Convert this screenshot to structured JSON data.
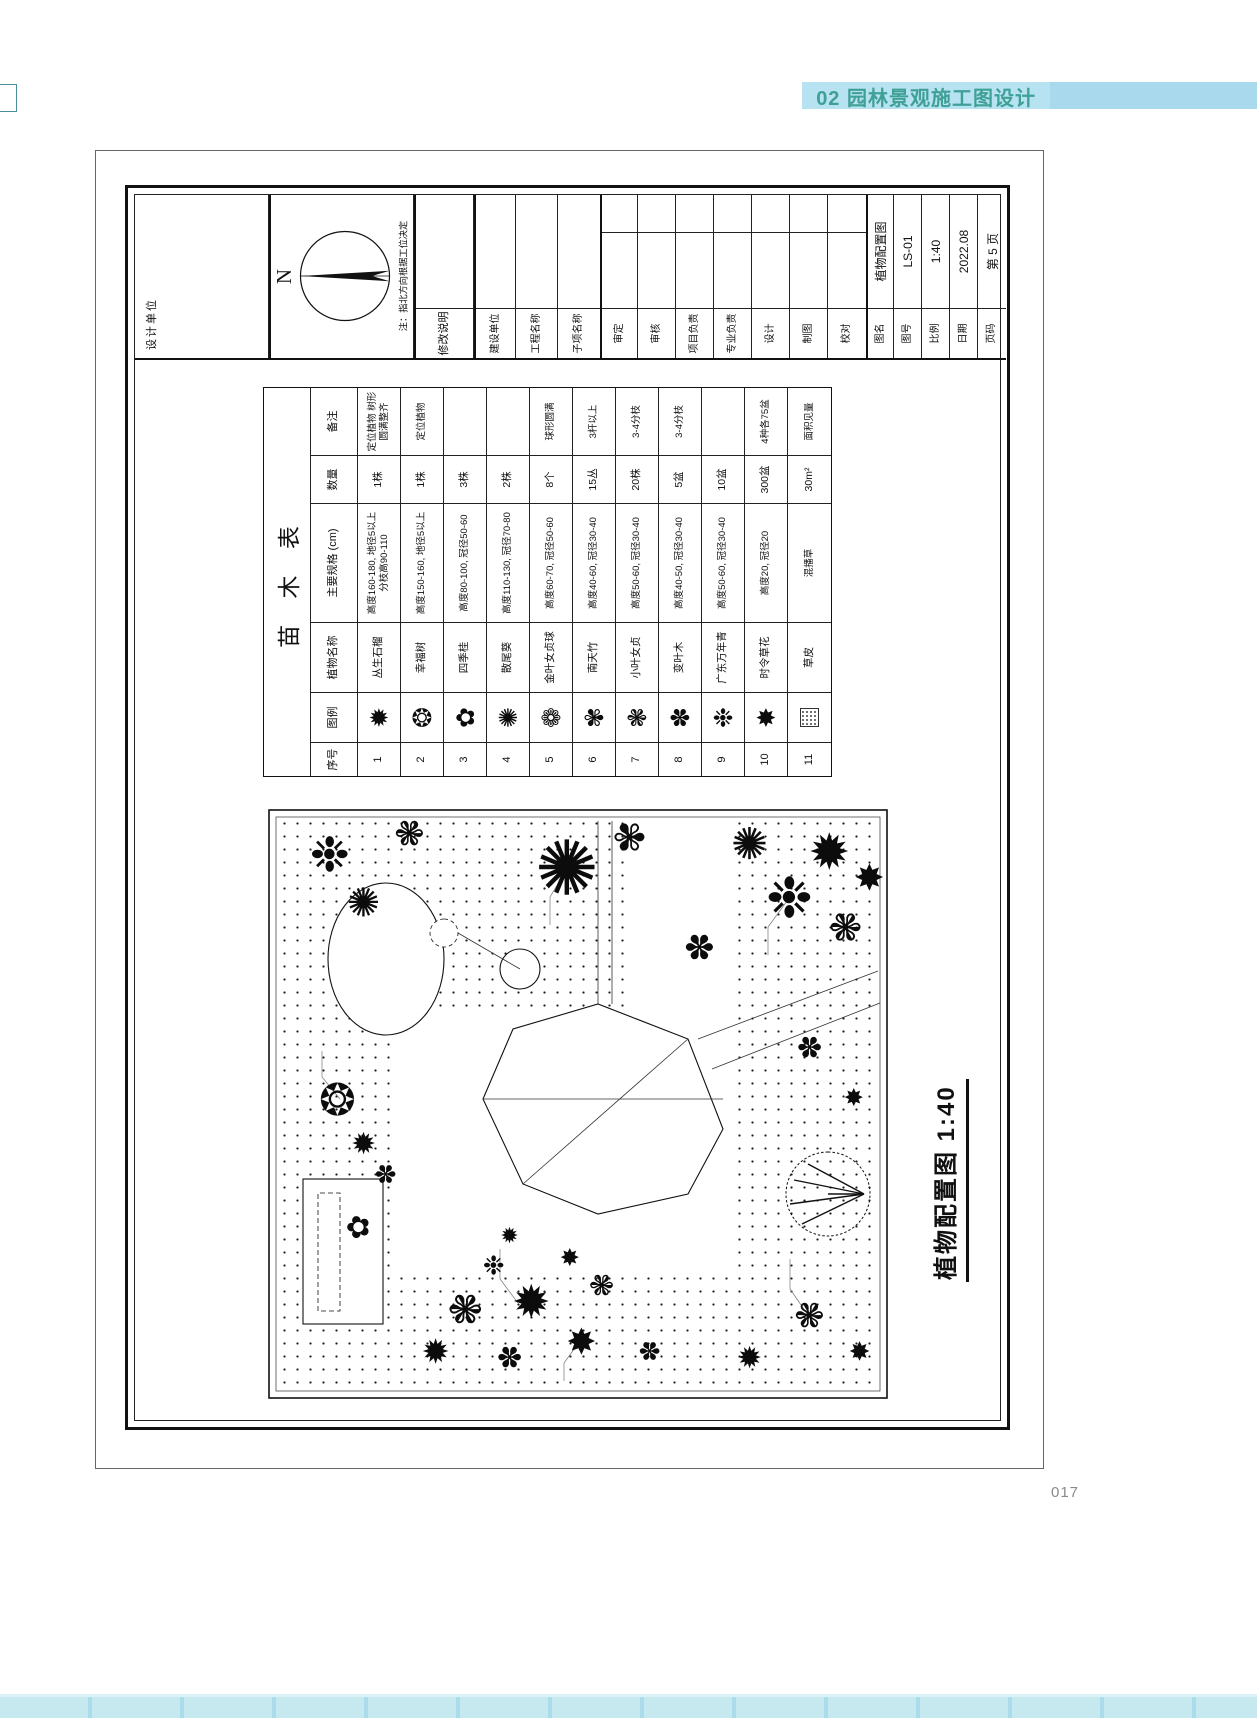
{
  "header": {
    "chapter": "02 园林景观施工图设计"
  },
  "page_number": "017",
  "title_block": {
    "design_unit_label": "设计单位",
    "north_letter": "N",
    "north_note": "注：指北方向根据工位决定",
    "revision_label": "修改说明",
    "project_fields": [
      {
        "label": "建设单位",
        "value": ""
      },
      {
        "label": "工程名称",
        "value": ""
      },
      {
        "label": "子项名称",
        "value": ""
      }
    ],
    "sign_fields": [
      {
        "label": "审定",
        "value": ""
      },
      {
        "label": "审核",
        "value": ""
      },
      {
        "label": "项目负责",
        "value": ""
      },
      {
        "label": "专业负责",
        "value": ""
      },
      {
        "label": "设计",
        "value": ""
      },
      {
        "label": "制图",
        "value": ""
      },
      {
        "label": "校对",
        "value": ""
      }
    ],
    "info_fields": [
      {
        "label": "图名",
        "value": "植物配置图"
      },
      {
        "label": "图号",
        "value": "LS-01"
      },
      {
        "label": "比例",
        "value": "1:40"
      },
      {
        "label": "日期",
        "value": "2022.08"
      },
      {
        "label": "页码",
        "value": "第 5 页"
      }
    ]
  },
  "plant_table": {
    "title": "苗 木 表",
    "headers": [
      "序号",
      "图例",
      "植物名称",
      "主要规格 (cm)",
      "数量",
      "备注"
    ],
    "rows": [
      {
        "no": "1",
        "symbol": "✹",
        "icon": "clump-pomegranate-icon",
        "name": "丛生石榴",
        "spec": "高度160-180, 地径5以上 分枝高90-110",
        "qty": "1株",
        "note": "定位植物 树形圆满整齐"
      },
      {
        "no": "2",
        "symbol": "❂",
        "icon": "happiness-tree-icon",
        "name": "幸福树",
        "spec": "高度150-160, 地径5以上",
        "qty": "1株",
        "note": "定位植物"
      },
      {
        "no": "3",
        "symbol": "✿",
        "icon": "osmanthus-icon",
        "name": "四季桂",
        "spec": "高度80-100, 冠径50-60",
        "qty": "3株",
        "note": ""
      },
      {
        "no": "4",
        "symbol": "✺",
        "icon": "areca-palm-icon",
        "name": "散尾葵",
        "spec": "高度110-130, 冠径70-80",
        "qty": "2株",
        "note": ""
      },
      {
        "no": "5",
        "symbol": "❁",
        "icon": "golden-privet-ball-icon",
        "name": "金叶女贞球",
        "spec": "高度60-70, 冠径50-60",
        "qty": "8个",
        "note": "球形圆满"
      },
      {
        "no": "6",
        "symbol": "✾",
        "icon": "nandina-icon",
        "name": "南天竹",
        "spec": "高度40-60, 冠径30-40",
        "qty": "15丛",
        "note": "3杆以上"
      },
      {
        "no": "7",
        "symbol": "❃",
        "icon": "small-privet-icon",
        "name": "小叶女贞",
        "spec": "高度50-60, 冠径30-40",
        "qty": "20株",
        "note": "3-4分枝"
      },
      {
        "no": "8",
        "symbol": "✽",
        "icon": "croton-icon",
        "name": "变叶木",
        "spec": "高度40-50, 冠径30-40",
        "qty": "5盆",
        "note": "3-4分枝"
      },
      {
        "no": "9",
        "symbol": "❉",
        "icon": "evergreen-icon",
        "name": "广东万年青",
        "spec": "高度50-60, 冠径30-40",
        "qty": "10盆",
        "note": ""
      },
      {
        "no": "10",
        "symbol": "✸",
        "icon": "seasonal-flower-icon",
        "name": "时令草花",
        "spec": "高度20, 冠径20",
        "qty": "300盆",
        "note": "4种各75盆"
      },
      {
        "no": "11",
        "symbol": "grass",
        "icon": "turf-swatch-icon",
        "name": "草皮",
        "spec": "混播草",
        "qty": "30m²",
        "note": "面积见量"
      }
    ]
  },
  "plan": {
    "caption": "植物配置图 1:40",
    "trees": [
      {
        "x": 48,
        "y": 168,
        "s": 34,
        "g": "✹"
      },
      {
        "x": 90,
        "y": 198,
        "s": 42,
        "g": "❃"
      },
      {
        "x": 42,
        "y": 242,
        "s": 30,
        "g": "✽"
      },
      {
        "x": 98,
        "y": 264,
        "s": 46,
        "g": "✹"
      },
      {
        "x": 58,
        "y": 314,
        "s": 36,
        "g": "✸"
      },
      {
        "x": 114,
        "y": 334,
        "s": 30,
        "g": "❃"
      },
      {
        "x": 48,
        "y": 382,
        "s": 26,
        "g": "✽"
      },
      {
        "x": 142,
        "y": 302,
        "s": 24,
        "g": "✸"
      },
      {
        "x": 164,
        "y": 242,
        "s": 22,
        "g": "✹"
      },
      {
        "x": 134,
        "y": 226,
        "s": 26,
        "g": "❉"
      },
      {
        "x": 42,
        "y": 482,
        "s": 30,
        "g": "✹"
      },
      {
        "x": 84,
        "y": 542,
        "s": 36,
        "g": "❃"
      },
      {
        "x": 48,
        "y": 592,
        "s": 26,
        "g": "✸"
      },
      {
        "x": 225,
        "y": 118,
        "s": 26,
        "g": "✽"
      },
      {
        "x": 172,
        "y": 90,
        "s": 30,
        "g": "✿"
      },
      {
        "x": 300,
        "y": 70,
        "s": 44,
        "g": "❂"
      },
      {
        "x": 256,
        "y": 96,
        "s": 30,
        "g": "✹"
      },
      {
        "x": 545,
        "y": 62,
        "s": 48,
        "g": "❉"
      },
      {
        "x": 497,
        "y": 96,
        "s": 40,
        "g": "✺"
      },
      {
        "x": 566,
        "y": 142,
        "s": 36,
        "g": "❃"
      },
      {
        "x": 532,
        "y": 300,
        "s": 76,
        "g": "✺"
      },
      {
        "x": 562,
        "y": 362,
        "s": 40,
        "g": "✾"
      },
      {
        "x": 452,
        "y": 432,
        "s": 36,
        "g": "✽"
      },
      {
        "x": 502,
        "y": 522,
        "s": 56,
        "g": "❉"
      },
      {
        "x": 548,
        "y": 562,
        "s": 50,
        "g": "✹"
      },
      {
        "x": 472,
        "y": 578,
        "s": 40,
        "g": "❃"
      },
      {
        "x": 556,
        "y": 482,
        "s": 44,
        "g": "✺"
      },
      {
        "x": 522,
        "y": 602,
        "s": 36,
        "g": "✸"
      },
      {
        "x": 352,
        "y": 542,
        "s": 30,
        "g": "✽"
      },
      {
        "x": 302,
        "y": 586,
        "s": 24,
        "g": "✸"
      },
      {
        "x": 205,
        "y": 560,
        "s": 84,
        "k": "canopy"
      }
    ]
  }
}
